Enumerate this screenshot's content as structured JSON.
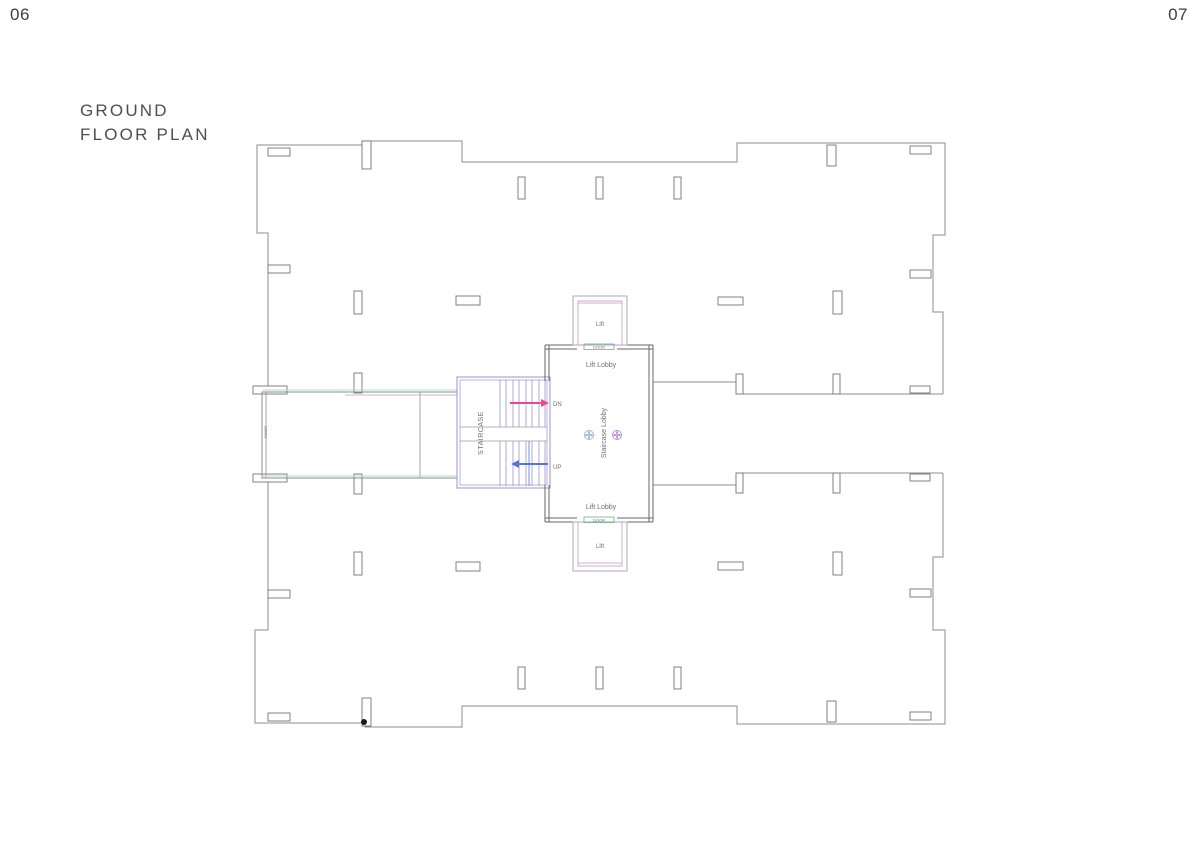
{
  "page": {
    "number_left": "06",
    "number_right": "07",
    "title": "GROUND FLOOR PLAN",
    "title_lines": [
      "GROUND",
      "FLOOR PLAN"
    ]
  },
  "plan": {
    "rooms": {
      "lift_top": "Lift",
      "lift_bottom": "Lift",
      "lift_lobby_top": "Lift Lobby",
      "lift_lobby_bottom": "Lift Lobby",
      "staircase_lobby": "Staircase Lobby",
      "staircase": "STAIRCASE"
    },
    "annotations": {
      "down": "DN",
      "up": "UP",
      "door_top": "DOOR",
      "door_bottom": "DOOR",
      "door_left": "DOOR"
    },
    "colors": {
      "outline_gray": "#8e8e8e",
      "column_gray": "#757575",
      "wall_dark": "#676767",
      "stair_purple": "#9b92cf",
      "lift_purple": "#b3a0cc",
      "lift_pink": "#d98ba6",
      "arrow_down_pink": "#e84a90",
      "arrow_up_blue": "#5872d8",
      "door_green": "#6fae8c",
      "guide_teal": "#abdcd0",
      "guide_magenta": "#c79ec4",
      "marker_blue": "#9db3dd",
      "marker_purple": "#bd8fd6"
    }
  }
}
